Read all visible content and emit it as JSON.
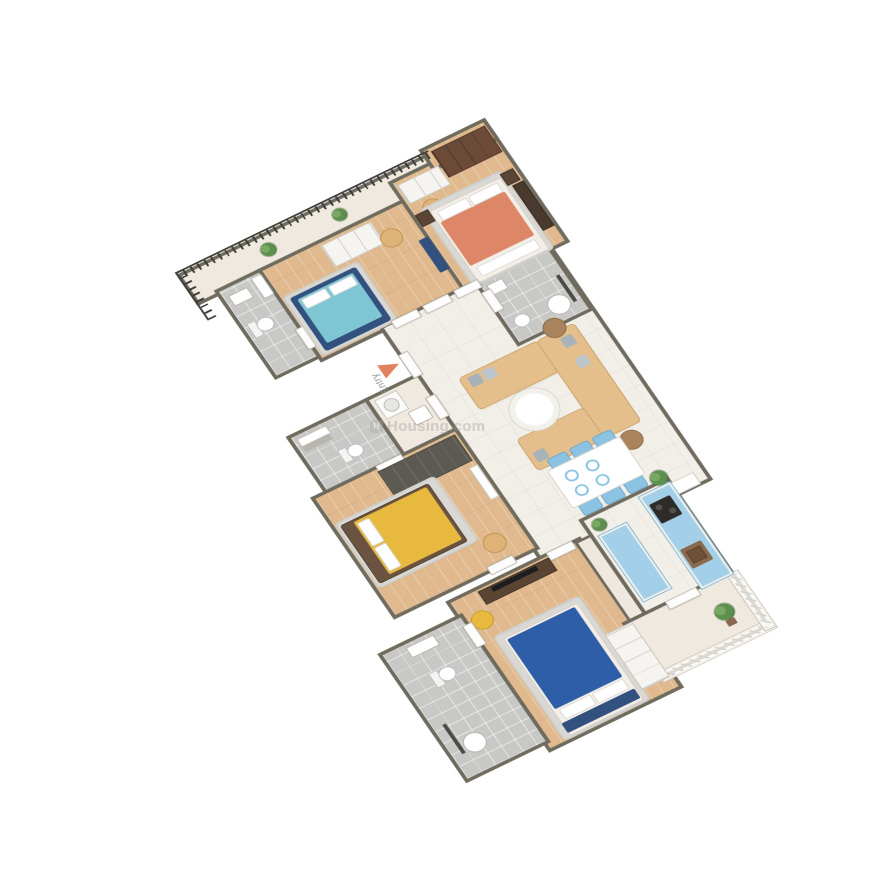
{
  "scene": {
    "type": "3d-isometric-floor-plan",
    "background": "#ffffff"
  },
  "labels": {
    "entry": "Entry"
  },
  "watermark": {
    "text": "Housing.com",
    "mark": "H"
  },
  "palette": {
    "wall": "#6f6b5e",
    "wall_light": "#efe8df",
    "wood_floor": "#e0ba8e",
    "marble_floor": "#f2eee8",
    "tile_floor": "#c8c8c6",
    "balcony_floor": "#efe9e0",
    "railing_dark": "#3e3c38",
    "railing_white": "#f5f2ec",
    "bed_teal": "#7fc6d4",
    "bed_frame_navy": "#32517e",
    "bed_coral": "#dd8668",
    "bed_yellow": "#e7b93e",
    "bed_blue": "#2f5ea8",
    "sofa_tan": "#e4bf8c",
    "chair_tan": "#dfb277",
    "dining_chair_blue": "#8cc3e2",
    "kitchen_blue": "#a3d0e8",
    "wardrobe_white": "#f6f4f0",
    "wardrobe_brown": "#6b4a38",
    "wardrobe_dark": "#5c5a52",
    "rug_gray": "#d9d8d4",
    "pillow_gray": "#a8b2ba",
    "stove_black": "#2e2c2a",
    "sink_brown": "#8a6a4e",
    "tv_black": "#1e1e1e",
    "plant_green": "#5d8f4e",
    "entry_arrow": "#e0825f"
  },
  "rooms": [
    {
      "name": "balcony-top",
      "floor": "balcony"
    },
    {
      "name": "bathroom-1",
      "floor": "tile"
    },
    {
      "name": "bedroom-1",
      "floor": "wood"
    },
    {
      "name": "bedroom-2",
      "floor": "wood"
    },
    {
      "name": "common-bathroom",
      "floor": "tile"
    },
    {
      "name": "living-dining",
      "floor": "marble"
    },
    {
      "name": "bathroom-3",
      "floor": "tile"
    },
    {
      "name": "hall-utility",
      "floor": "balcony"
    },
    {
      "name": "bedroom-3",
      "floor": "wood"
    },
    {
      "name": "bedroom-4",
      "floor": "wood"
    },
    {
      "name": "bathroom-4",
      "floor": "tile"
    },
    {
      "name": "kitchen",
      "floor": "marble"
    },
    {
      "name": "balcony-kitchen",
      "floor": "balcony"
    }
  ],
  "furniture": [
    "teal-double-bed",
    "coral-double-bed",
    "yellow-double-bed",
    "blue-double-bed",
    "white-sliding-wardrobes",
    "brown-wardrobe",
    "dark-gray-wardrobe",
    "white-wardrobe",
    "tan-sofa-set-u-shape",
    "round-coffee-table",
    "dining-table-6-blue-chairs",
    "blue-kitchen-counters-stove-sink",
    "tv-console",
    "accent-chairs",
    "toilets",
    "washbasins",
    "showers",
    "potted-plants",
    "balcony-railings"
  ]
}
